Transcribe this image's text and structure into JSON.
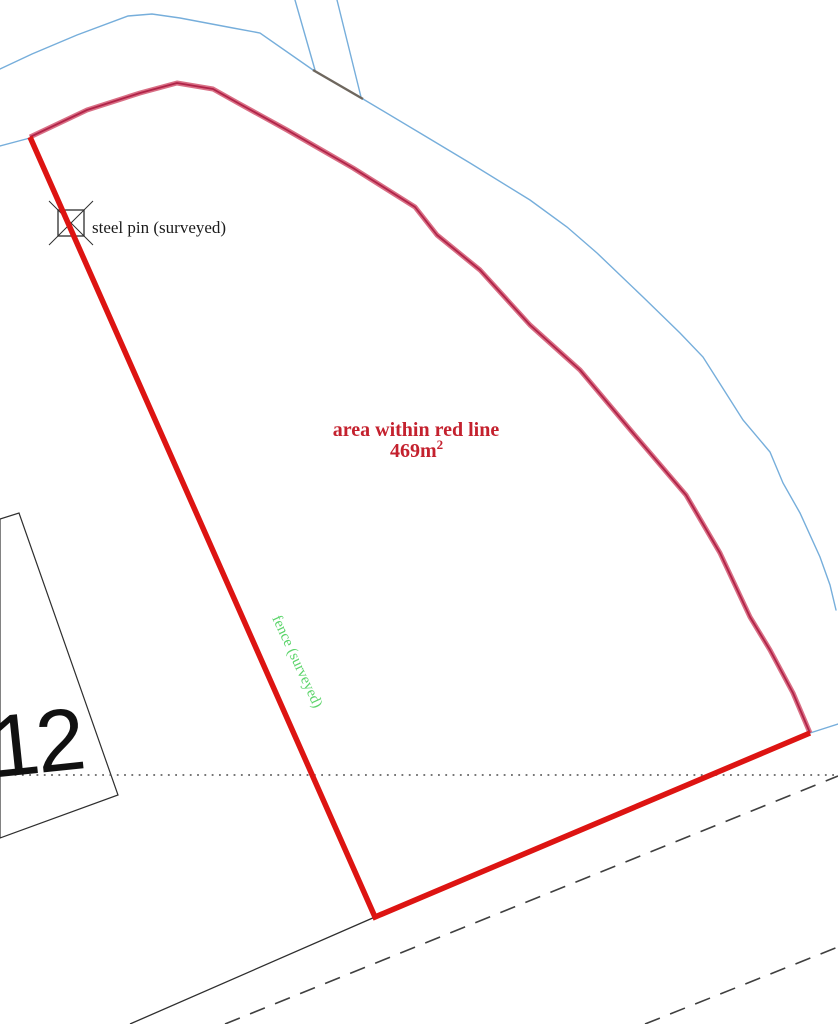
{
  "labels": {
    "steel_pin": "steel pin (surveyed)",
    "area_line1": "area within red line",
    "area_value": "469m",
    "area_exponent": "2",
    "fence": "fence (surveyed)",
    "house_number": "12"
  },
  "colors": {
    "background": "#ffffff",
    "red_line": "#dd1412",
    "boundary_outer": "#d96f85",
    "boundary_core": "#b02348",
    "road_blue": "#76aedb",
    "line_black": "#2e2e2e",
    "dashed_gray": "#3f3f3f",
    "dotted_gray": "#4a4a4a",
    "driveway_bar": "#6e675e",
    "area_text": "#c4212e",
    "fence_text": "#5bd46a",
    "pin_text": "#1b1b1b",
    "house_number_text": "#111111"
  },
  "geometry": {
    "road_blue_main": "0,69 32,54 77,35 128,16 152,14 180,18 233,28 260,33 313,70 363,99 420,133 470,163 530,200 567,227 597,253 643,297 680,333 703,357 743,420 770,452 783,483 800,513 820,557 830,585 836,610",
    "driveway_west": "295,0 315,70",
    "driveway_east": "337,0 361,97",
    "driveway_bar": "313,70 363,99",
    "road_blue_left_stub": "0,146 30,138",
    "road_blue_corner_stub": "810,733 838,724",
    "boundary_surveyed": "30,137 87,110 140,93 177,83 213,89 238,103 287,130 353,168 415,207 437,235 480,270 530,325 580,370 633,433 686,495 720,553 750,617 770,650 793,693 810,733",
    "boundary_red": "30,137 375,917 810,733",
    "building": "0,519 19,513 118,795 0,838",
    "road_edge_black": "130,1024 375,917",
    "track_dashed_upper": "225,1024 838,776",
    "track_dashed_lower": "645,1024 838,947",
    "boundary_dotted": "0,775 838,775",
    "pin_cross_a": "49,201 93,245",
    "pin_cross_b": "93,201 49,245"
  },
  "pin_symbol": {
    "x": 58,
    "y": 210,
    "size": 26
  }
}
